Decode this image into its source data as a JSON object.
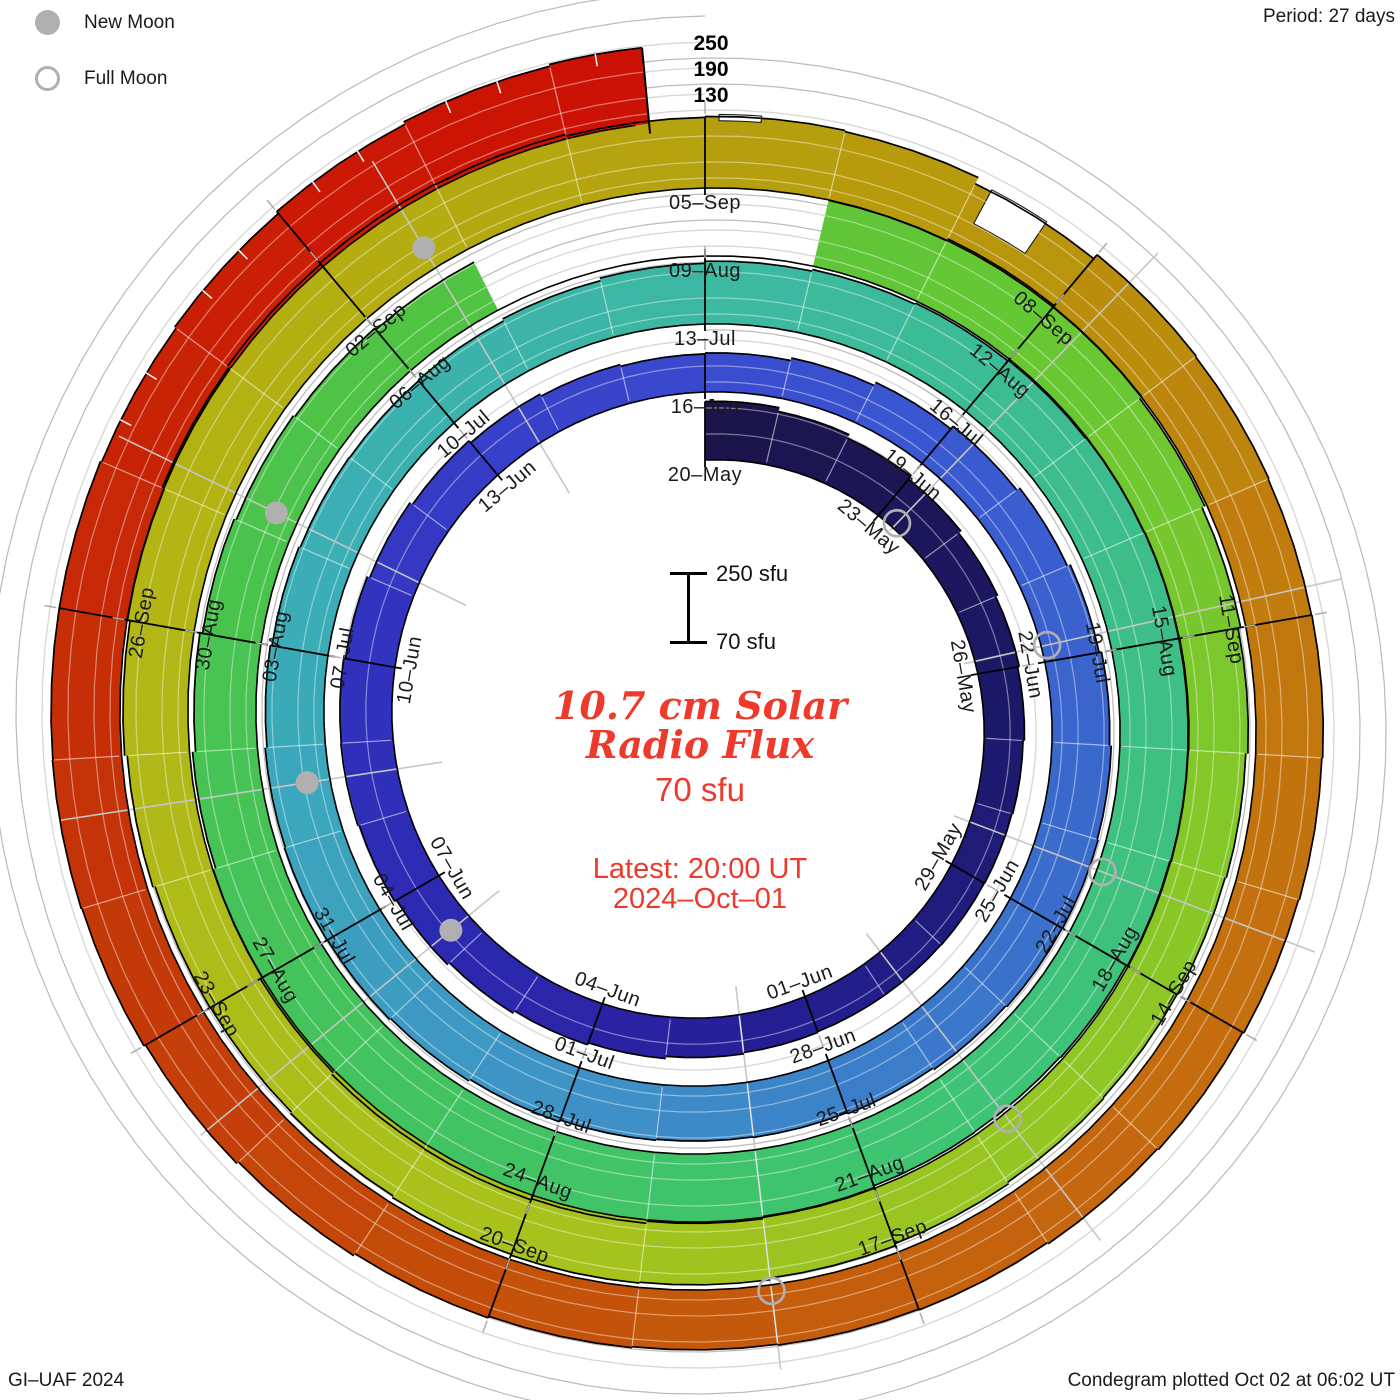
{
  "meta": {
    "period_label": "Period: 27 days",
    "credit": "GI–UAF 2024",
    "plotted": "Condegram plotted Oct 02 at 06:02 UT"
  },
  "legend": {
    "new_moon": "New Moon",
    "full_moon": "Full Moon"
  },
  "center": {
    "title_line1": "10.7 cm Solar",
    "title_line2": "Radio Flux",
    "latest_flux": "70 sfu",
    "latest_label": "Latest: 20:00 UT",
    "latest_date": "2024–Oct–01"
  },
  "scalebar": {
    "top": "250 sfu",
    "bottom": "70 sfu"
  },
  "radial_axis": [
    "250",
    "190",
    "130"
  ],
  "chart_data": {
    "type": "spiral-bar-condegram",
    "title": "10.7 cm Solar Radio Flux",
    "start_date": "2024-05-20",
    "end_date": "2024-10-01",
    "days_per_turn": 27,
    "baseline_sfu": 70,
    "gridlines_sfu": [
      130,
      190,
      250
    ],
    "center_x": 705,
    "center_y": 722,
    "base_radius": 262,
    "ring_growth": 68,
    "px_per_sfu": 0.4333,
    "tick_labels": [
      "20–May",
      "23–May",
      "26–May",
      "29–May",
      "01–Jun",
      "04–Jun",
      "07–Jun",
      "10–Jun",
      "13–Jun",
      "16–Jun",
      "19–Jun",
      "22–Jun",
      "25–Jun",
      "28–Jun",
      "01–Jul",
      "04–Jul",
      "07–Jul",
      "10–Jul",
      "13–Jul",
      "16–Jul",
      "19–Jul",
      "22–Jul",
      "25–Jul",
      "28–Jul",
      "31–Jul",
      "03–Aug",
      "06–Aug",
      "09–Aug",
      "12–Aug",
      "15–Aug",
      "18–Aug",
      "21–Aug",
      "24–Aug",
      "27–Aug",
      "30–Aug",
      "02–Sep",
      "05–Sep",
      "08–Sep",
      "11–Sep",
      "14–Sep",
      "17–Sep",
      "20–Sep",
      "23–Sep",
      "26–Sep"
    ],
    "flux_sfu": [
      205,
      196,
      187,
      179,
      172,
      167,
      163,
      160,
      158,
      157,
      156,
      156,
      158,
      161,
      166,
      171,
      177,
      183,
      188,
      191,
      190,
      186,
      180,
      173,
      167,
      162,
      158,
      160,
      166,
      174,
      182,
      190,
      197,
      203,
      207,
      209,
      208,
      205,
      201,
      198,
      197,
      199,
      203,
      207,
      210,
      211,
      209,
      205,
      201,
      198,
      197,
      199,
      204,
      210,
      215,
      219,
      222,
      224,
      226,
      228,
      229,
      228,
      225,
      222,
      220,
      221,
      225,
      230,
      235,
      238,
      237,
      232,
      226,
      220,
      213,
      207,
      202,
      198,
      194,
      null,
      null,
      null,
      226,
      231,
      228,
      222,
      215,
      209,
      204,
      201,
      200,
      202,
      206,
      211,
      215,
      217,
      215,
      211,
      208,
      209,
      214,
      220,
      226,
      231,
      235,
      238,
      237,
      233,
      235,
      232,
      216,
      228,
      226,
      224,
      225,
      223,
      221,
      218,
      215,
      212,
      210,
      208,
      210,
      214,
      219,
      224,
      228,
      230,
      229,
      229,
      226,
      230,
      236,
      242,
      246
    ],
    "color_stops": [
      [
        0,
        "#1b1548"
      ],
      [
        6,
        "#1d1866"
      ],
      [
        12,
        "#221e8e"
      ],
      [
        15,
        "#2a24a8"
      ],
      [
        21,
        "#3132bf"
      ],
      [
        26,
        "#3a46cc"
      ],
      [
        30,
        "#3a58d0"
      ],
      [
        36,
        "#3a6ecb"
      ],
      [
        42,
        "#3e93c6"
      ],
      [
        48,
        "#3aacb8"
      ],
      [
        54,
        "#3cb8a2"
      ],
      [
        60,
        "#3dbf87"
      ],
      [
        66,
        "#3fc470"
      ],
      [
        72,
        "#44c35a"
      ],
      [
        78,
        "#4fc344"
      ],
      [
        84,
        "#66c733"
      ],
      [
        90,
        "#8cc726"
      ],
      [
        96,
        "#a8c21b"
      ],
      [
        102,
        "#b2b615"
      ],
      [
        106,
        "#b4aa10"
      ],
      [
        110,
        "#b7990c"
      ],
      [
        114,
        "#c1790e"
      ],
      [
        118,
        "#c56a0e"
      ],
      [
        122,
        "#c4550a"
      ],
      [
        127,
        "#c43608"
      ],
      [
        131,
        "#c92005"
      ],
      [
        134,
        "#cc1204"
      ]
    ],
    "dips": [
      [
        108.25,
        0.3,
        225
      ],
      [
        110.35,
        0.45,
        132
      ]
    ],
    "sample_slits": [
      130.3,
      130.65,
      131.3,
      131.65,
      132.3,
      132.65,
      133.3,
      133.65,
      134.3
    ],
    "new_moon_days": [
      17.3,
      46.6,
      76.2,
      105.7
    ],
    "full_moon_days": [
      3.3,
      32.8,
      62.3,
      91.7,
      121.0
    ],
    "data_end_day": 134.6,
    "legend_position": "top-left",
    "grid_on": true
  }
}
